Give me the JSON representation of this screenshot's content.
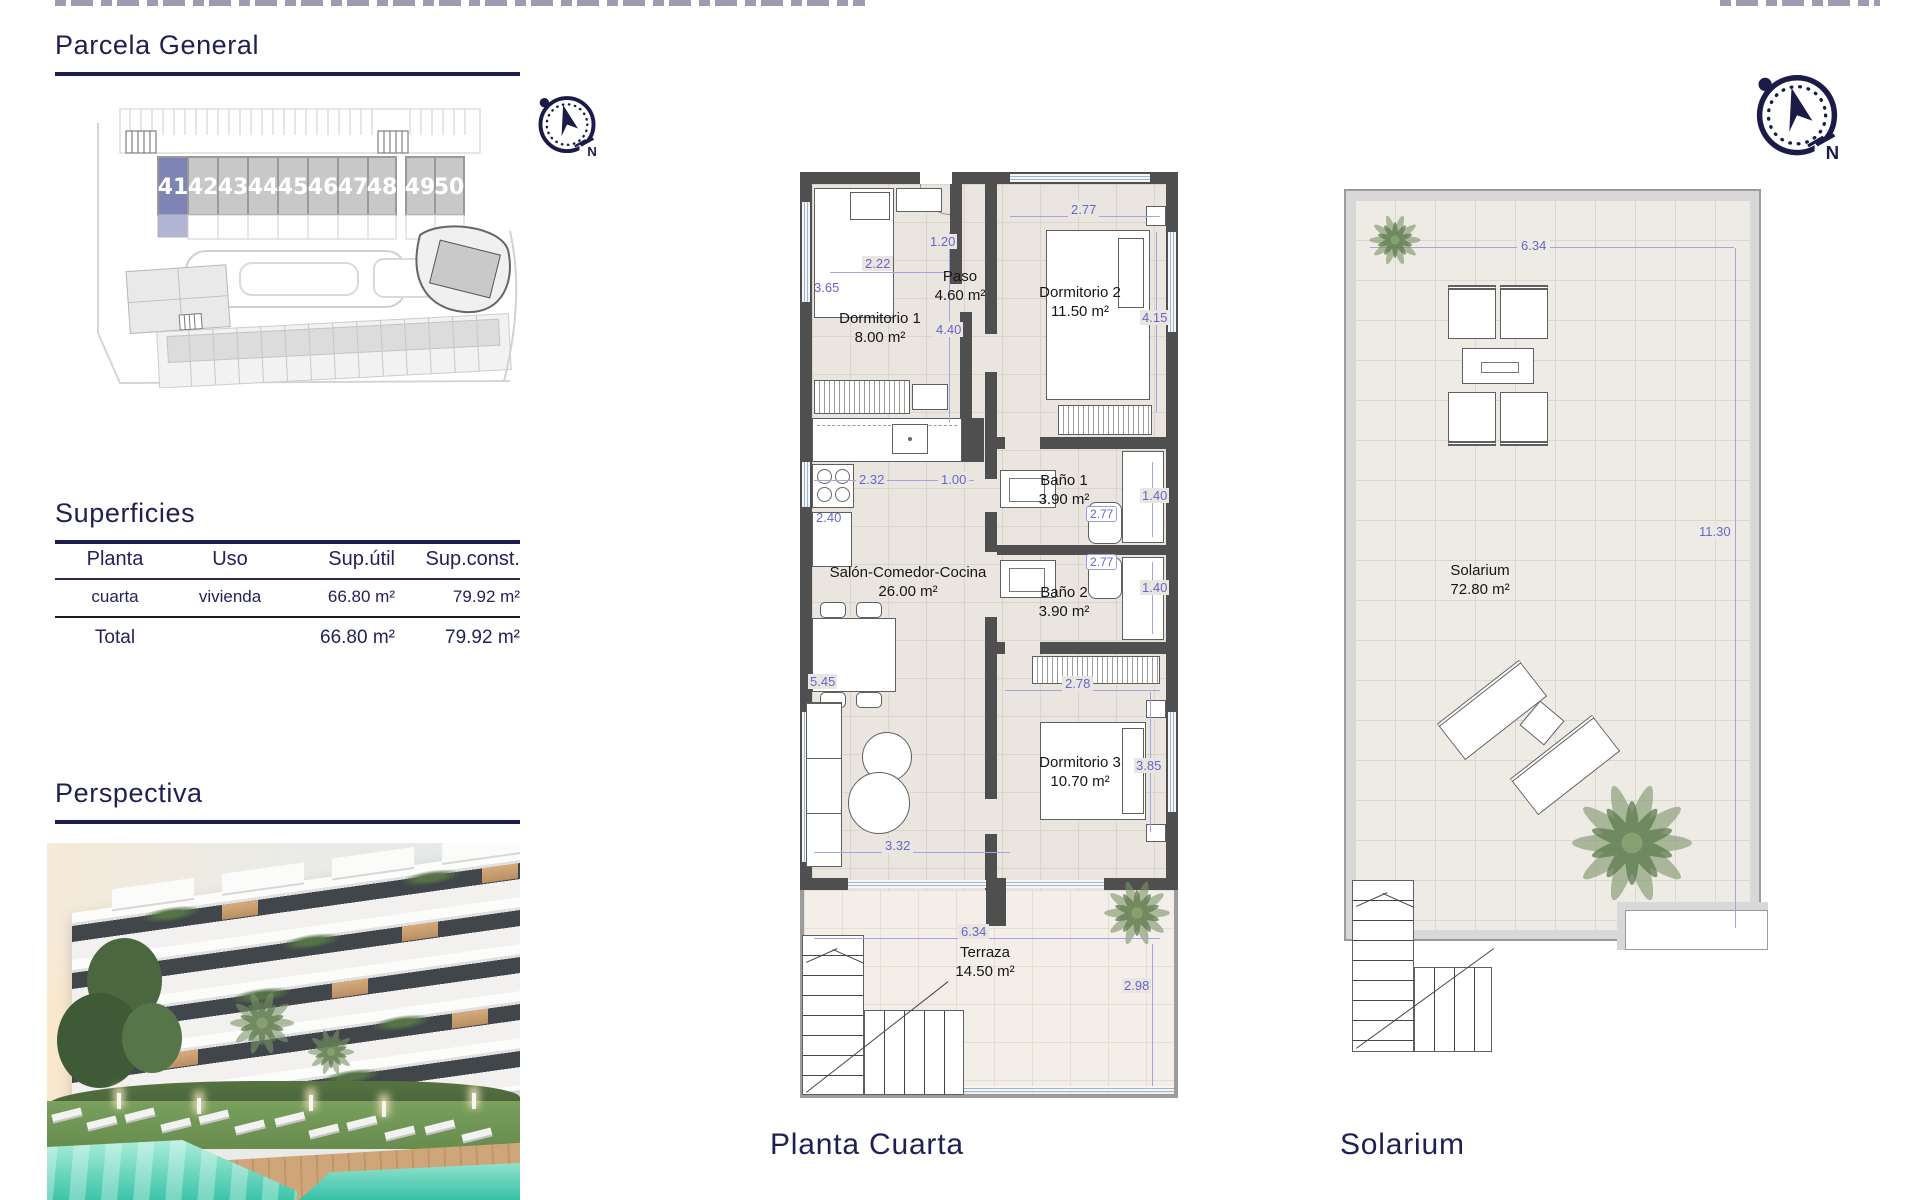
{
  "titles": {
    "parcela": "Parcela General",
    "superficies": "Superficies",
    "perspectiva": "Perspectiva"
  },
  "captions": {
    "floorplan": "Planta Cuarta",
    "solarium": "Solarium"
  },
  "site": {
    "units": [
      "41",
      "42",
      "43",
      "44",
      "45",
      "46",
      "47",
      "48",
      "49",
      "50"
    ],
    "highlighted_unit": "41"
  },
  "superficies_table": {
    "headers": [
      "Planta",
      "Uso",
      "Sup.útil",
      "Sup.const."
    ],
    "row": {
      "planta": "cuarta",
      "uso": "vivienda",
      "sup_util": "66.80 m²",
      "sup_const": "79.92 m²"
    },
    "total": {
      "label": "Total",
      "sup_util": "66.80 m²",
      "sup_const": "79.92 m²"
    }
  },
  "floorplan": {
    "rooms": [
      {
        "name": "Dormitorio 1",
        "area": "8.00 m²"
      },
      {
        "name": "Paso",
        "area": "4.60 m²"
      },
      {
        "name": "Dormitorio 2",
        "area": "11.50 m²"
      },
      {
        "name": "Baño 1",
        "area": "3.90 m²"
      },
      {
        "name": "Salón-Comedor-Cocina",
        "area": "26.00 m²"
      },
      {
        "name": "Baño 2",
        "area": "3.90 m²"
      },
      {
        "name": "Dormitorio 3",
        "area": "10.70 m²"
      },
      {
        "name": "Terraza",
        "area": "14.50 m²"
      }
    ],
    "dims": {
      "dorm1_h": "3.65",
      "dorm1_w": "2.22",
      "paso_w": "1.20",
      "paso_h": "4.40",
      "dorm2_w": "2.77",
      "dorm2_h": "4.15",
      "cocina_w": "2.32",
      "cocina_gap": "1.00",
      "cocina_h": "2.40",
      "bano1_h": "1.40",
      "bano1_w": "2.77",
      "bano2_w": "2.77",
      "bano2_h": "1.40",
      "salon_h": "5.45",
      "dorm3_w": "2.78",
      "dorm3_h": "3.85",
      "salon_w": "3.32",
      "terraza_w": "6.34",
      "terraza_h": "2.98"
    }
  },
  "solarium_plan": {
    "name": "Solarium",
    "area": "72.80 m²",
    "dims": {
      "width": "6.34",
      "height": "11.30"
    }
  },
  "compass": {
    "north": "N"
  },
  "colors": {
    "heading_navy": "#201f52",
    "dim_blue": "#6465cf",
    "wall_gray": "#4f4f4f",
    "floor_beige": "#eae6df",
    "unit_highlight": "#7e84b5",
    "pool_teal": "#3cc4a8"
  }
}
